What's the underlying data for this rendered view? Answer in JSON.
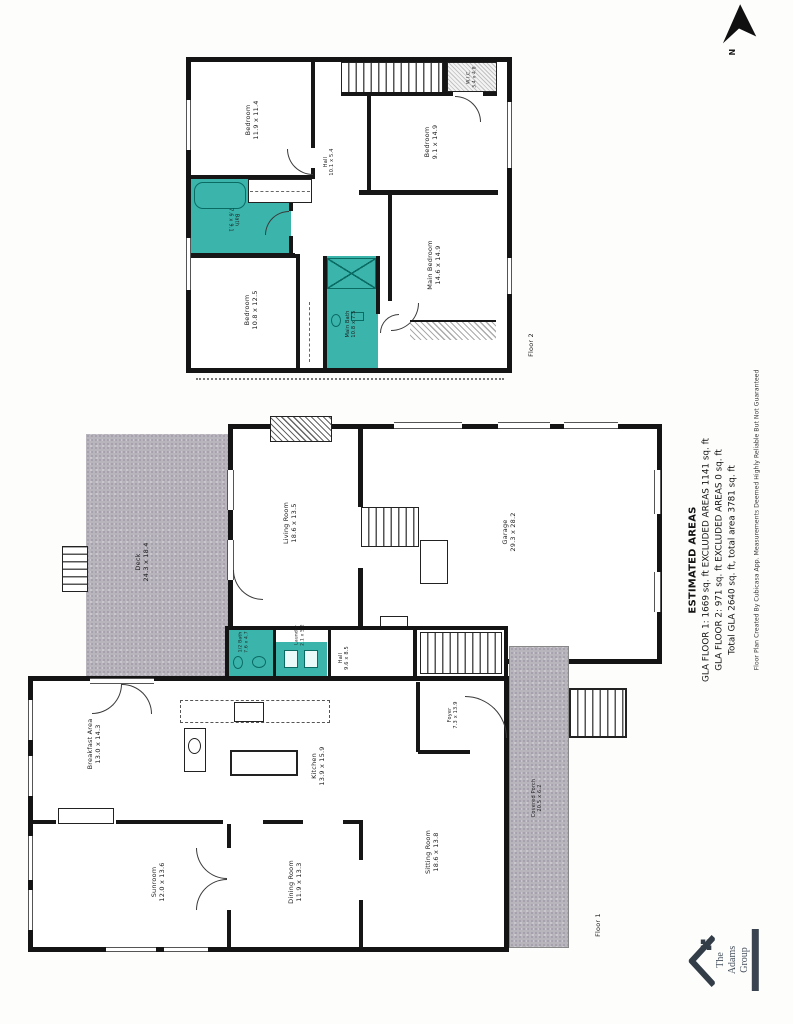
{
  "page": {
    "compass_label": "N"
  },
  "estimated_areas": {
    "title": "ESTIMATED AREAS",
    "line1": "GLA FLOOR 1: 1669 sq. ft EXCLUDED AREAS 1141 sq. ft",
    "line2": "GLA FLOOR 2: 971 sq. ft EXCLUDED AREAS 0 sq. ft",
    "line3": "Total GLA 2640 sq. ft, total area 3781 sq. ft",
    "disclaimer": "Floor Plan Created By Cubicasa App. Measurements Deemed Highly Reliable But Not Guaranteed"
  },
  "floor2": {
    "caption": "Floor 2",
    "rooms": [
      {
        "name": "Bedroom",
        "dims": "11.9 x 11.4"
      },
      {
        "name": "Hall",
        "dims": "10.1 x 5.4"
      },
      {
        "name": "Bath",
        "dims": "7.6 x 9.1"
      },
      {
        "name": "Bedroom",
        "dims": "9.1 x 14.9"
      },
      {
        "name": "W.I.C.",
        "dims": "3.4 x 4.8"
      },
      {
        "name": "Main Bedroom",
        "dims": "14.6 x 14.9"
      },
      {
        "name": "Bedroom",
        "dims": "10.8 x 12.5"
      },
      {
        "name": "Main Bath",
        "dims": "10.8 x 7.5"
      }
    ]
  },
  "floor1": {
    "caption": "Floor 1",
    "rooms": [
      {
        "name": "Deck",
        "dims": "24.3 x 18.4"
      },
      {
        "name": "Living Room",
        "dims": "18.6 x 13.5"
      },
      {
        "name": "Garage",
        "dims": "29.3 x 28.2"
      },
      {
        "name": "Breakfast Area",
        "dims": "13.0 x 14.3"
      },
      {
        "name": "Kitchen",
        "dims": "13.9 x 15.9"
      },
      {
        "name": "1/2 Bath",
        "dims": "7.6 x 4.7"
      },
      {
        "name": "Laundry",
        "dims": "2.1 x 5.2"
      },
      {
        "name": "Hall",
        "dims": "9.6 x 8.5"
      },
      {
        "name": "Foyer",
        "dims": "7.3 x 13.9"
      },
      {
        "name": "Covered Porch",
        "dims": "20.5 x 6.2"
      },
      {
        "name": "Sunroom",
        "dims": "12.0 x 13.6"
      },
      {
        "name": "Dining Room",
        "dims": "11.9 x 13.3"
      },
      {
        "name": "Sitting Room",
        "dims": "18.6 x 13.8"
      }
    ]
  },
  "logo": {
    "line1": "The",
    "line2": "Adams",
    "line3": "Group"
  },
  "colors": {
    "bath_fill": "#3bb5ac",
    "deck_fill": "#b9b5bd",
    "wall": "#161616"
  }
}
